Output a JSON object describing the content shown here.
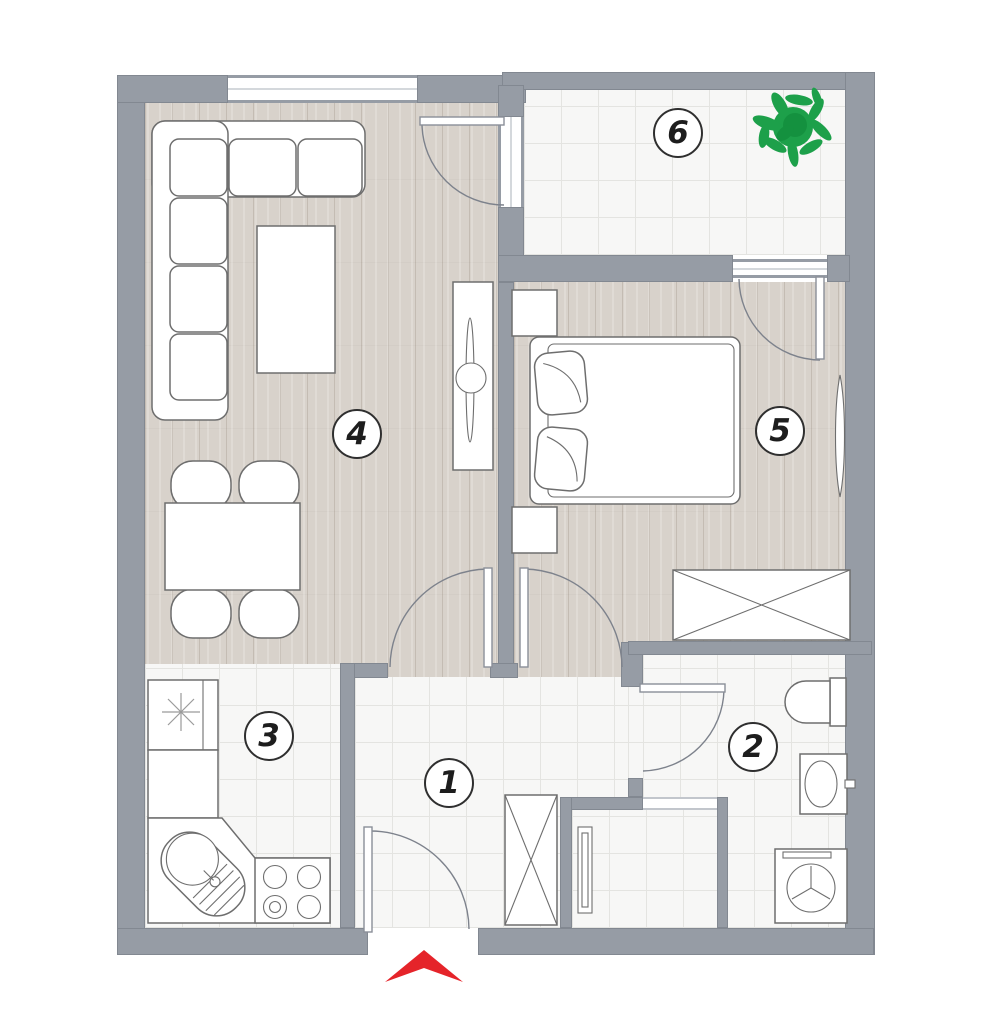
{
  "floorplan": {
    "rooms": [
      {
        "number": "1",
        "type": "hallway"
      },
      {
        "number": "2",
        "type": "bathroom"
      },
      {
        "number": "3",
        "type": "kitchen"
      },
      {
        "number": "4",
        "type": "living-room"
      },
      {
        "number": "5",
        "type": "bedroom"
      },
      {
        "number": "6",
        "type": "balcony"
      }
    ],
    "icons": {
      "plant": "plant-icon",
      "entrance": "entrance-arrow-icon"
    },
    "colors": {
      "wall": "#969ca5",
      "wood_floor": "#d8d2cb",
      "tile_floor": "#f7f7f6",
      "tile_line": "#e4e4e1",
      "furniture_outline": "#6e6e6e",
      "label_border": "#2f2f2f",
      "plant_green": "#1da04a",
      "entrance_red": "#e5242a"
    }
  }
}
